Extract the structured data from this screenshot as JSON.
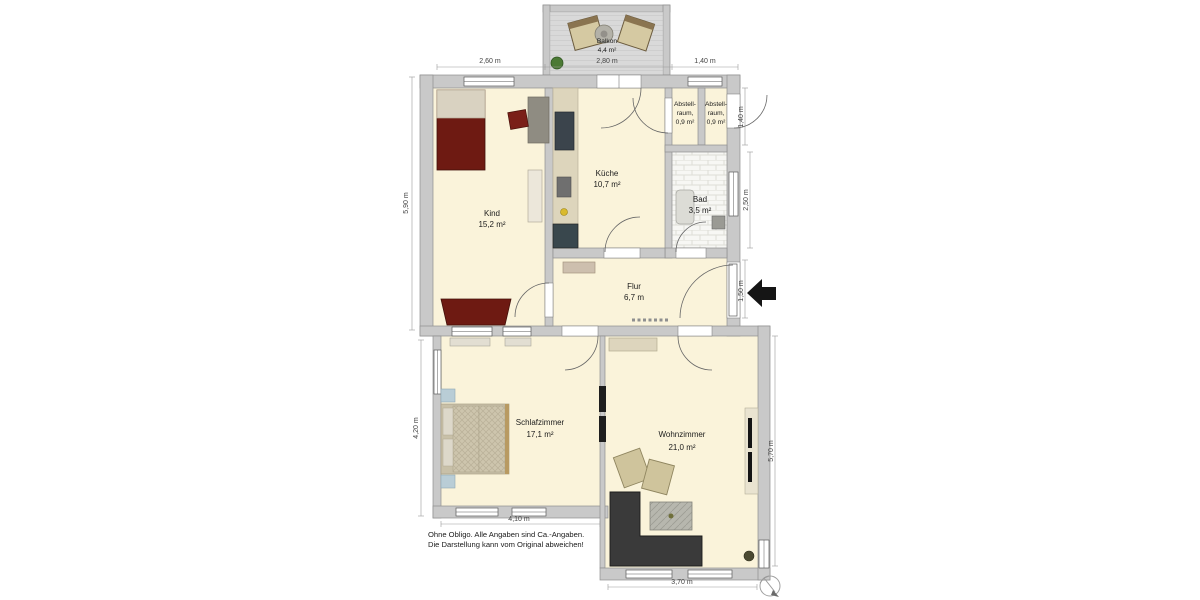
{
  "rooms": {
    "balkon": {
      "name": "Balkon",
      "area": "4,4 m²"
    },
    "kind": {
      "name": "Kind",
      "area": "15,2 m²"
    },
    "kueche": {
      "name": "Küche",
      "area": "10,7 m²"
    },
    "abstellraum1": {
      "line1": "Abstell-",
      "line2": "raum,",
      "area": "0,9 m²"
    },
    "abstellraum2": {
      "line1": "Abstell-",
      "line2": "raum,",
      "area": "0,9 m²"
    },
    "bad": {
      "name": "Bad",
      "area": "3,5 m²"
    },
    "flur": {
      "name": "Flur",
      "area": "6,7 m"
    },
    "schlafzimmer": {
      "name": "Schlafzimmer",
      "area": "17,1 m²"
    },
    "wohnzimmer": {
      "name": "Wohnzimmer",
      "area": "21,0 m²"
    }
  },
  "dimensions": {
    "top_left": "2,60 m",
    "top_middle": "2,80 m",
    "top_right": "1,40 m",
    "left_upper": "5,90 m",
    "left_lower": "4,20 m",
    "bottom_left": "4,10 m",
    "bottom_right": "3,70 m",
    "right_abstell": "1,40 m",
    "right_bad": "2,50 m",
    "right_entrance": "1,50 m",
    "right_lower": "5,70 m"
  },
  "disclaimer": {
    "line1": "Ohne Obligo. Alle Angaben sind Ca.-Angaben.",
    "line2": "Die Darstellung kann vom Original abweichen!"
  },
  "icons": {
    "entrance_arrow": "left-arrow-entrance-marker",
    "compass": "north-compass-rose"
  },
  "colors": {
    "wall": "#c9c9c9",
    "floor": "#faf3da",
    "furniture_red": "#6e1a12",
    "sofa_dark": "#3a3a3a",
    "counter_tan": "#ddd5bc",
    "nightstand_blue": "#b9cdd6"
  }
}
